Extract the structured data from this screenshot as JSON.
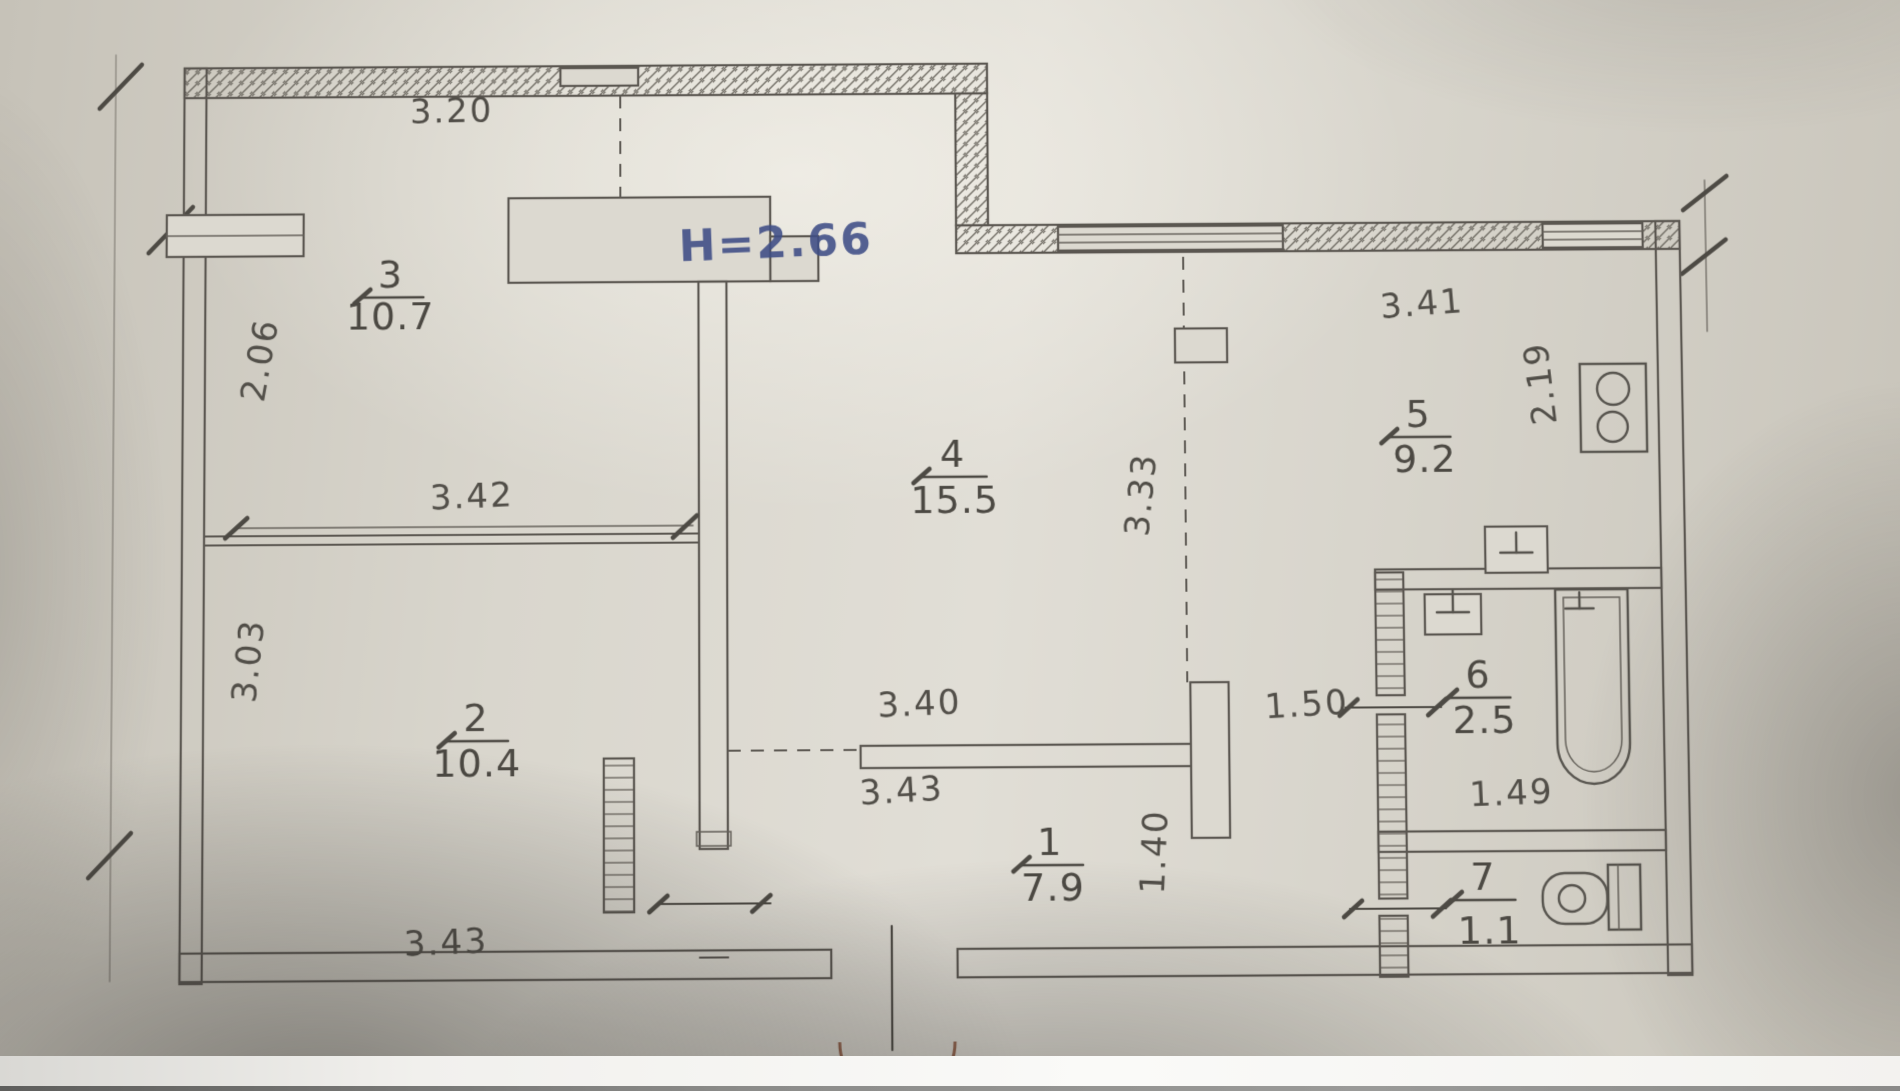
{
  "plan": {
    "ceiling_height_label": "H=2.66",
    "rooms": [
      {
        "number": "1",
        "area": "7.9"
      },
      {
        "number": "2",
        "area": "10.4"
      },
      {
        "number": "3",
        "area": "10.7"
      },
      {
        "number": "4",
        "area": "15.5"
      },
      {
        "number": "5",
        "area": "9.2"
      },
      {
        "number": "6",
        "area": "2.5"
      },
      {
        "number": "7",
        "area": "1.1"
      }
    ],
    "dimensions": {
      "top_wall": "3.20",
      "room3_side": "2.06",
      "rooms_2_3_width": "3.42",
      "room2_side": "3.03",
      "bottom_left": "3.43",
      "room4_opening": "3.40",
      "corridor_wall": "3.43",
      "room4_kitchen_side": "3.33",
      "kitchen_width": "3.41",
      "kitchen_side": "2.19",
      "kitchen_opening": "1.50",
      "corridor_width": "1.40",
      "bathroom_width": "1.49"
    },
    "fixtures": [
      "stove-icon",
      "sink-icon",
      "bathtub-icon",
      "toilet-icon",
      "water-heater-icon",
      "entrance-door-arc"
    ]
  }
}
